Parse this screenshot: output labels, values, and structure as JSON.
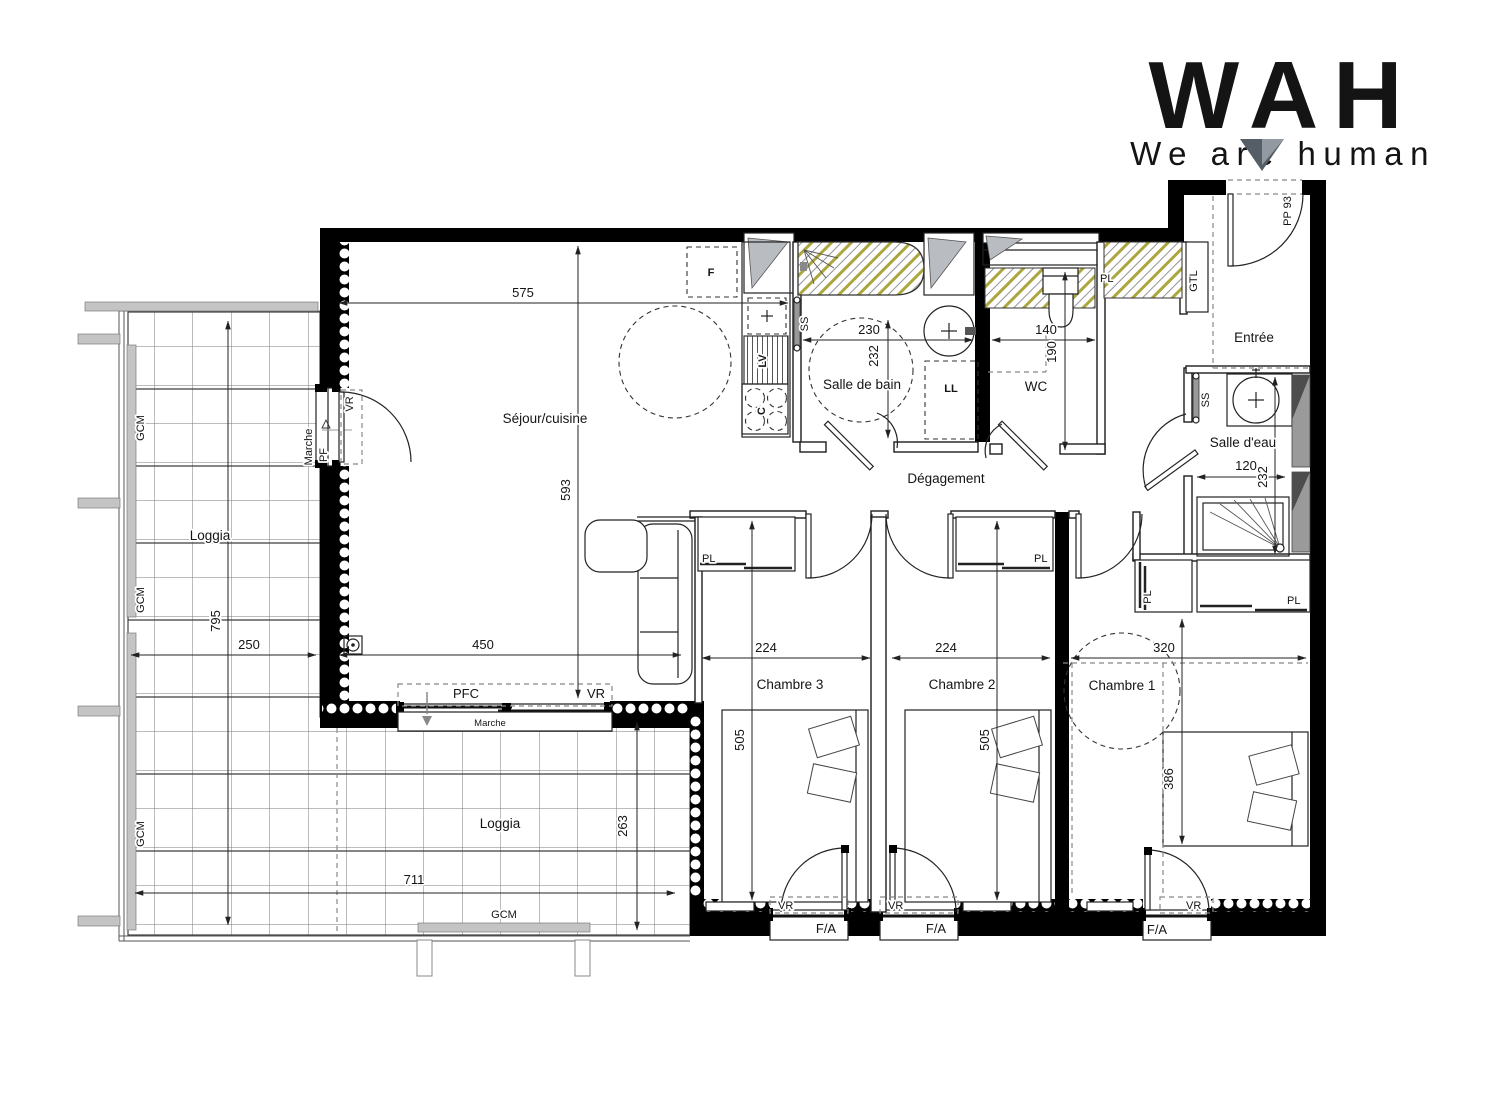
{
  "logo": {
    "title": "WAH",
    "tagline": "We are human"
  },
  "rooms": {
    "sejour": "Séjour/cuisine",
    "bain": "Salle de bain",
    "wc": "WC",
    "degagement": "Dégagement",
    "entree": "Entrée",
    "eau": "Salle d'eau",
    "ch1": "Chambre 1",
    "ch2": "Chambre 2",
    "ch3": "Chambre 3",
    "loggia": "Loggia"
  },
  "dims": {
    "d575": "575",
    "d593": "593",
    "d450": "450",
    "d230": "230",
    "d232": "232",
    "d140": "140",
    "d190": "190",
    "d120": "120",
    "d224": "224",
    "d320": "320",
    "d505": "505",
    "d386": "386",
    "d795": "795",
    "d250": "250",
    "d711": "711",
    "d263": "263"
  },
  "ann": {
    "pf": "PF",
    "pfc": "PFC",
    "vr": "VR",
    "marche": "Marche",
    "gcm": "GCM",
    "fa": "F/A",
    "pl": "PL",
    "gtl": "GTL",
    "pp": "PP 93",
    "f": "F",
    "lv": "LV",
    "c": "C",
    "ss": "SS",
    "ll": "LL"
  },
  "colors": {
    "wall": "#000000",
    "hatch": "#aca63e",
    "glass": "#b9bdc2",
    "logo_text": "#9bacc2",
    "logo_tagline": "#92a2b8",
    "logo_mark": "#555e67",
    "logo_mark_light": "#9299a1"
  }
}
